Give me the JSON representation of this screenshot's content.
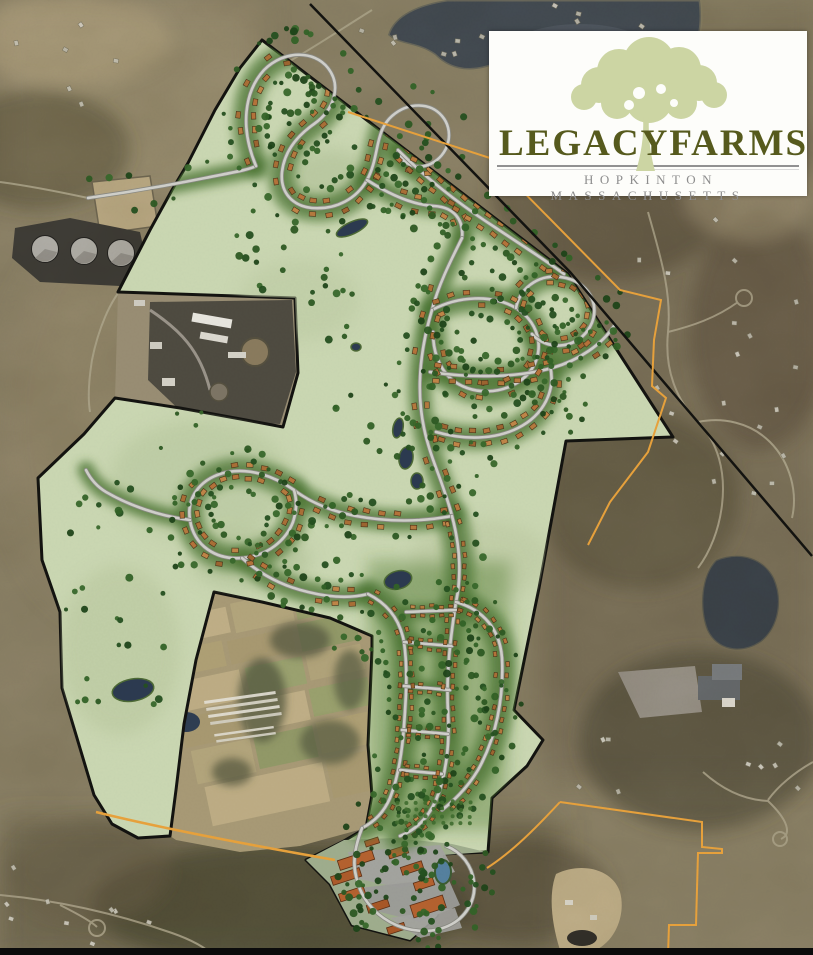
{
  "logo": {
    "title_left": "LEGACY",
    "title_right": "FARMS",
    "subtitle": "HOPKINTON MASSACHUSETTS"
  },
  "colors": {
    "logo_text": "#565a1d",
    "logo_subtitle": "#8d8d8d",
    "logo_tree": "#ccd5a3",
    "plan_area_fill": "#cbd8b3",
    "plan_boundary": "#131310",
    "parcel_line": "#e8a23c",
    "road_fill": "#d0d0cb",
    "road_casing": "#8a8a83",
    "house": "#b0763c",
    "tree": "#2d5a23",
    "vegetation_band": "#50793a",
    "water": "#454d55",
    "marsh_pond": "#2c3a50",
    "village_pond": "#55819f",
    "aerial_base": "#8e8469"
  }
}
